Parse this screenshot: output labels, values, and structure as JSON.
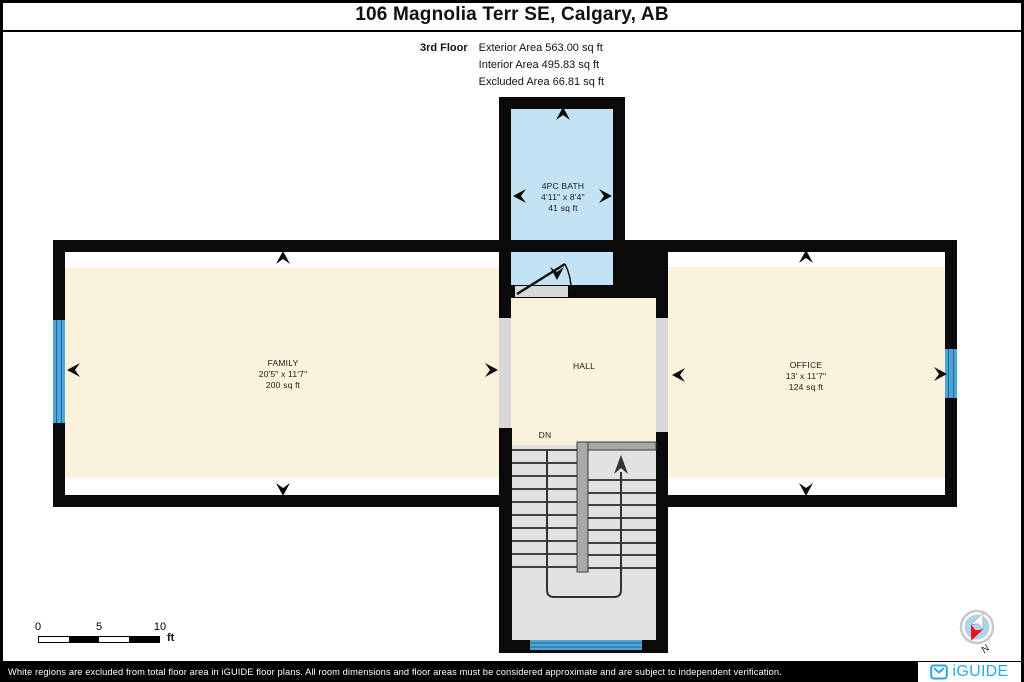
{
  "header": {
    "title": "106 Magnolia Terr SE, Calgary, AB",
    "floor_label": "3rd Floor",
    "stats": [
      "Exterior Area 563.00 sq ft",
      "Interior Area 495.83 sq ft",
      "Excluded Area 66.81 sq ft"
    ]
  },
  "rooms": {
    "bath": {
      "name": "4PC BATH",
      "dims": "4'11\" x 8'4\"",
      "area": "41 sq ft"
    },
    "family": {
      "name": "FAMILY",
      "dims": "20'5\" x 11'7\"",
      "area": "200 sq ft"
    },
    "office": {
      "name": "OFFICE",
      "dims": "13' x 11'7\"",
      "area": "124 sq ft"
    },
    "hall": {
      "name": "HALL"
    },
    "stairs": {
      "down_label": "DN"
    }
  },
  "scale_bar": {
    "labels": [
      "0",
      "5",
      "10"
    ],
    "unit": "ft"
  },
  "compass": {
    "north_label": "N"
  },
  "footer": {
    "disclaimer": "White regions are excluded from total floor area in iGUIDE floor plans. All room dimensions and floor areas must be considered approximate and are subject to independent verification.",
    "brand": "iGUIDE"
  },
  "colors": {
    "room_floor": "#FAF2DA",
    "bath_floor": "#C3E2F3",
    "stair_floor": "#E2E2E2",
    "window_blue": "#4DA6D8",
    "wall_black": "#0A0A0A",
    "brand_blue": "#29ABE2",
    "compass_red": "#E8111C"
  }
}
